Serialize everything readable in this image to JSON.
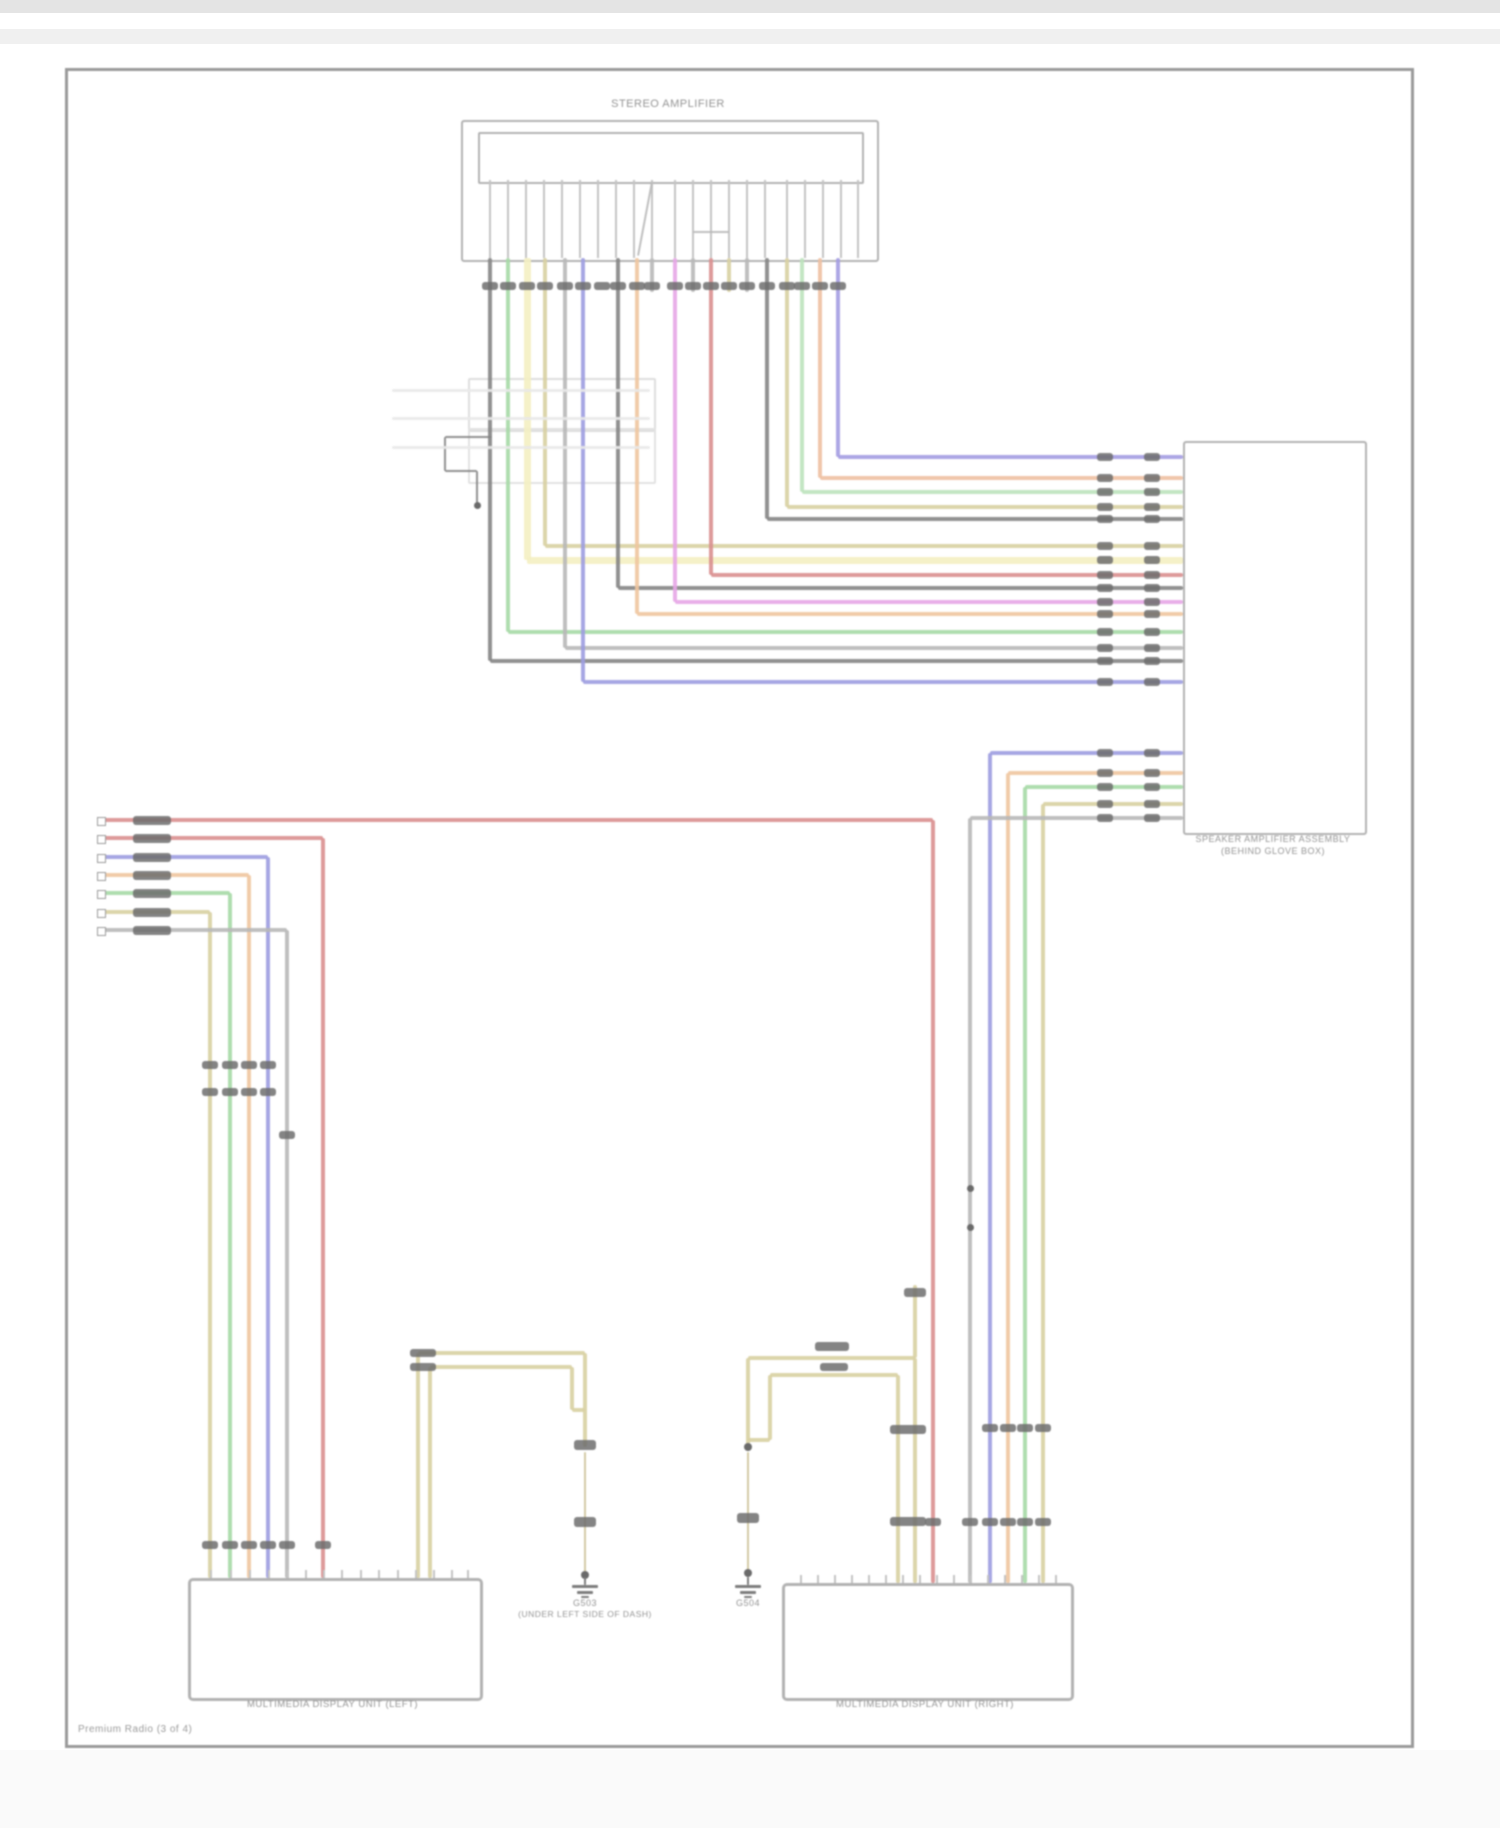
{
  "page": {
    "top_box_label": "STEREO AMPLIFIER",
    "right_box_label_line1": "SPEAKER AMPLIFIER ASSEMBLY",
    "right_box_label_line2": "(BEHIND GLOVE BOX)",
    "bottom_left_box_label": "MULTIMEDIA DISPLAY UNIT (LEFT)",
    "bottom_right_box_label": "MULTIMEDIA DISPLAY UNIT (RIGHT)",
    "ground_left_id": "G503",
    "ground_left_note": "(UNDER LEFT SIDE OF DASH)",
    "ground_right_id": "G504",
    "footer": "Premium Radio (3 of 4)"
  },
  "colors": {
    "red": "#d98f8f",
    "blue": "#9d9de0",
    "purple": "#a49ce2",
    "green": "#a6d9a6",
    "lightgreen": "#bce3bc",
    "tan": "#d8d0a2",
    "tanthin": "#cdc49a",
    "paleyellow": "#f4f0c2",
    "orange": "#f0c7a0",
    "peach": "#eec0a2",
    "magenta": "#e7a6e7",
    "gray": "#b8b8b8",
    "black": "#858585",
    "ghost": "#e9e9e9",
    "pin": "#c4c4c4",
    "blob": "#6e6e6e",
    "border": "#b2b2b2",
    "text": "#949494"
  },
  "diagram": {
    "top_pins": [
      490,
      508,
      526,
      544,
      562,
      580,
      598,
      616,
      634,
      652,
      675,
      693,
      711,
      729,
      747,
      765,
      787,
      805,
      823,
      841,
      858
    ],
    "pin_squares": {
      "x": 97,
      "ys": [
        817,
        835,
        854,
        872,
        890,
        909,
        927
      ]
    },
    "stub_rows": [
      {
        "y1": 1570,
        "y2": 1578,
        "xs": [
          210,
          230,
          249,
          268,
          287,
          305,
          323,
          341,
          360,
          378,
          397,
          415,
          433,
          451,
          467
        ]
      },
      {
        "y1": 1575,
        "y2": 1583,
        "xs": [
          800,
          817,
          834,
          851,
          868,
          885,
          902,
          919,
          936,
          953,
          970,
          987,
          1004,
          1021,
          1038,
          1055
        ]
      }
    ],
    "segments": [
      [
        "v",
        838,
        258,
        457,
        "purple"
      ],
      [
        "h",
        838,
        1183,
        457,
        "purple"
      ],
      [
        "v",
        820,
        258,
        478,
        "peach"
      ],
      [
        "h",
        820,
        1183,
        478,
        "peach"
      ],
      [
        "v",
        802,
        258,
        492,
        "lightgreen"
      ],
      [
        "h",
        802,
        1183,
        492,
        "lightgreen"
      ],
      [
        "v",
        787,
        258,
        507,
        "tan"
      ],
      [
        "h",
        787,
        1183,
        507,
        "tan"
      ],
      [
        "v",
        767,
        258,
        519,
        "black"
      ],
      [
        "h",
        767,
        1183,
        519,
        "black"
      ],
      [
        "v",
        545,
        258,
        546,
        "tan"
      ],
      [
        "h",
        545,
        1183,
        546,
        "tan"
      ],
      [
        "v",
        527,
        258,
        560,
        "paleyellow",
        7
      ],
      [
        "h",
        527,
        1183,
        560,
        "paleyellow",
        7
      ],
      [
        "v",
        711,
        258,
        575,
        "red"
      ],
      [
        "h",
        711,
        1183,
        575,
        "red"
      ],
      [
        "v",
        618,
        258,
        588,
        "black"
      ],
      [
        "h",
        618,
        1183,
        588,
        "black"
      ],
      [
        "v",
        675,
        258,
        602,
        "magenta"
      ],
      [
        "h",
        675,
        1183,
        602,
        "magenta"
      ],
      [
        "v",
        637,
        258,
        614,
        "orange"
      ],
      [
        "h",
        637,
        1183,
        614,
        "orange"
      ],
      [
        "v",
        508,
        258,
        632,
        "green"
      ],
      [
        "h",
        508,
        1183,
        632,
        "green"
      ],
      [
        "v",
        565,
        258,
        648,
        "gray"
      ],
      [
        "h",
        565,
        1183,
        648,
        "gray"
      ],
      [
        "v",
        490,
        258,
        661,
        "black"
      ],
      [
        "h",
        490,
        1183,
        661,
        "black"
      ],
      [
        "v",
        583,
        258,
        682,
        "blue"
      ],
      [
        "h",
        583,
        1183,
        682,
        "blue"
      ],
      [
        "v",
        652,
        258,
        292,
        "gray"
      ],
      [
        "v",
        693,
        258,
        292,
        "gray"
      ],
      [
        "v",
        729,
        258,
        292,
        "tan"
      ],
      [
        "v",
        747,
        258,
        292,
        "gray"
      ],
      [
        "d",
        652,
        182,
        638,
        256,
        "gray",
        2
      ],
      [
        "h",
        693,
        729,
        232,
        "gray",
        2
      ],
      [
        "h",
        990,
        1183,
        753,
        "blue"
      ],
      [
        "v",
        990,
        753,
        1583,
        "blue"
      ],
      [
        "h",
        1008,
        1183,
        773,
        "orange"
      ],
      [
        "v",
        1008,
        773,
        1583,
        "orange"
      ],
      [
        "h",
        1025,
        1183,
        787,
        "green"
      ],
      [
        "v",
        1025,
        787,
        1583,
        "green"
      ],
      [
        "h",
        1043,
        1183,
        804,
        "tan"
      ],
      [
        "v",
        1043,
        804,
        1583,
        "tan"
      ],
      [
        "h",
        970,
        1183,
        818,
        "gray"
      ],
      [
        "v",
        970,
        818,
        1583,
        "gray"
      ],
      [
        "h",
        103,
        933,
        820,
        "red"
      ],
      [
        "v",
        933,
        820,
        1583,
        "red"
      ],
      [
        "h",
        103,
        323,
        838,
        "red"
      ],
      [
        "v",
        323,
        838,
        1578,
        "red"
      ],
      [
        "h",
        103,
        268,
        857,
        "blue"
      ],
      [
        "v",
        268,
        857,
        1578,
        "blue"
      ],
      [
        "h",
        103,
        249,
        875,
        "orange"
      ],
      [
        "v",
        249,
        875,
        1578,
        "orange"
      ],
      [
        "h",
        103,
        230,
        893,
        "green"
      ],
      [
        "v",
        230,
        893,
        1578,
        "green"
      ],
      [
        "h",
        103,
        210,
        912,
        "tan"
      ],
      [
        "v",
        210,
        912,
        1578,
        "tan"
      ],
      [
        "h",
        103,
        287,
        930,
        "gray"
      ],
      [
        "v",
        287,
        930,
        1578,
        "gray"
      ],
      [
        "h",
        418,
        585,
        1353,
        "tan"
      ],
      [
        "h",
        430,
        572,
        1367,
        "tan"
      ],
      [
        "v",
        418,
        1353,
        1578,
        "tan"
      ],
      [
        "v",
        430,
        1367,
        1578,
        "tan"
      ],
      [
        "v",
        585,
        1353,
        1447,
        "tan"
      ],
      [
        "v",
        572,
        1367,
        1410,
        "tan"
      ],
      [
        "h",
        572,
        585,
        1410,
        "tan"
      ],
      [
        "v",
        585,
        1452,
        1575,
        "tanthin",
        2
      ],
      [
        "h",
        748,
        915,
        1358,
        "tan"
      ],
      [
        "h",
        770,
        898,
        1375,
        "tan"
      ],
      [
        "v",
        748,
        1358,
        1445,
        "tan"
      ],
      [
        "v",
        770,
        1375,
        1440,
        "tan"
      ],
      [
        "h",
        748,
        770,
        1440,
        "tan"
      ],
      [
        "v",
        748,
        1452,
        1573,
        "tanthin",
        2
      ],
      [
        "v",
        915,
        1285,
        1358,
        "tan"
      ],
      [
        "v",
        915,
        1358,
        1583,
        "tan"
      ],
      [
        "v",
        898,
        1375,
        1583,
        "tan"
      ],
      [
        "h",
        445,
        492,
        437,
        "black",
        2
      ],
      [
        "v",
        445,
        437,
        471,
        "black",
        2
      ],
      [
        "h",
        445,
        477,
        471,
        "black",
        2
      ],
      [
        "v",
        477,
        471,
        503,
        "black",
        2
      ],
      [
        "h",
        392,
        650,
        390,
        "ghost",
        3
      ],
      [
        "h",
        392,
        650,
        418,
        "ghost",
        3
      ],
      [
        "h",
        392,
        650,
        447,
        "ghost",
        3
      ]
    ],
    "blob_rows_on_x": [
      {
        "y": 286,
        "xs": [
          490,
          508,
          527,
          545,
          565,
          583,
          602,
          618,
          637,
          652,
          675,
          693,
          711,
          729,
          747,
          767,
          787,
          802,
          820,
          838
        ]
      },
      {
        "y": 1065,
        "xs": [
          210,
          230,
          249,
          268
        ]
      },
      {
        "y": 1092,
        "xs": [
          210,
          230,
          249,
          268
        ]
      },
      {
        "y": 1135,
        "xs": [
          287
        ]
      },
      {
        "y": 1545,
        "xs": [
          210,
          230,
          249,
          268,
          287,
          323
        ]
      },
      {
        "y": 1428,
        "xs": [
          990,
          1008,
          1025,
          1043
        ]
      },
      {
        "y": 1522,
        "xs": [
          933,
          970,
          990,
          1008,
          1025,
          1043
        ]
      }
    ],
    "blob_rows_on_y": [
      {
        "x": 1105,
        "ys": [
          457,
          478,
          492,
          507,
          519,
          546,
          560,
          575,
          588,
          602,
          614,
          632,
          648,
          661,
          682,
          753,
          773,
          787,
          804,
          818
        ]
      },
      {
        "x": 1152,
        "ys": [
          457,
          478,
          492,
          507,
          519,
          546,
          560,
          575,
          588,
          602,
          614,
          632,
          648,
          661,
          682,
          753,
          773,
          787,
          804,
          818
        ]
      },
      {
        "x": 152,
        "ys": [
          820,
          838,
          857,
          875,
          893,
          912,
          930
        ],
        "w": 38,
        "h": 9
      }
    ],
    "blobs": [
      [
        423,
        1353,
        26,
        8
      ],
      [
        423,
        1367,
        26,
        8
      ],
      [
        585,
        1445,
        22,
        10
      ],
      [
        585,
        1522,
        22,
        10
      ],
      [
        748,
        1518,
        22,
        10
      ],
      [
        908,
        1429,
        36,
        9
      ],
      [
        908,
        1521,
        36,
        9
      ],
      [
        915,
        1292,
        22,
        9
      ],
      [
        832,
        1346,
        34,
        9
      ],
      [
        834,
        1367,
        28,
        8
      ]
    ],
    "dots": [
      [
        585,
        1575,
        4
      ],
      [
        748,
        1447,
        4
      ],
      [
        748,
        1573,
        4
      ],
      [
        970,
        1188,
        3.5
      ],
      [
        970,
        1227,
        3.5
      ],
      [
        477,
        505,
        3.5
      ]
    ],
    "grounds": [
      {
        "x": 585,
        "y": 1577
      },
      {
        "x": 748,
        "y": 1577
      }
    ]
  }
}
